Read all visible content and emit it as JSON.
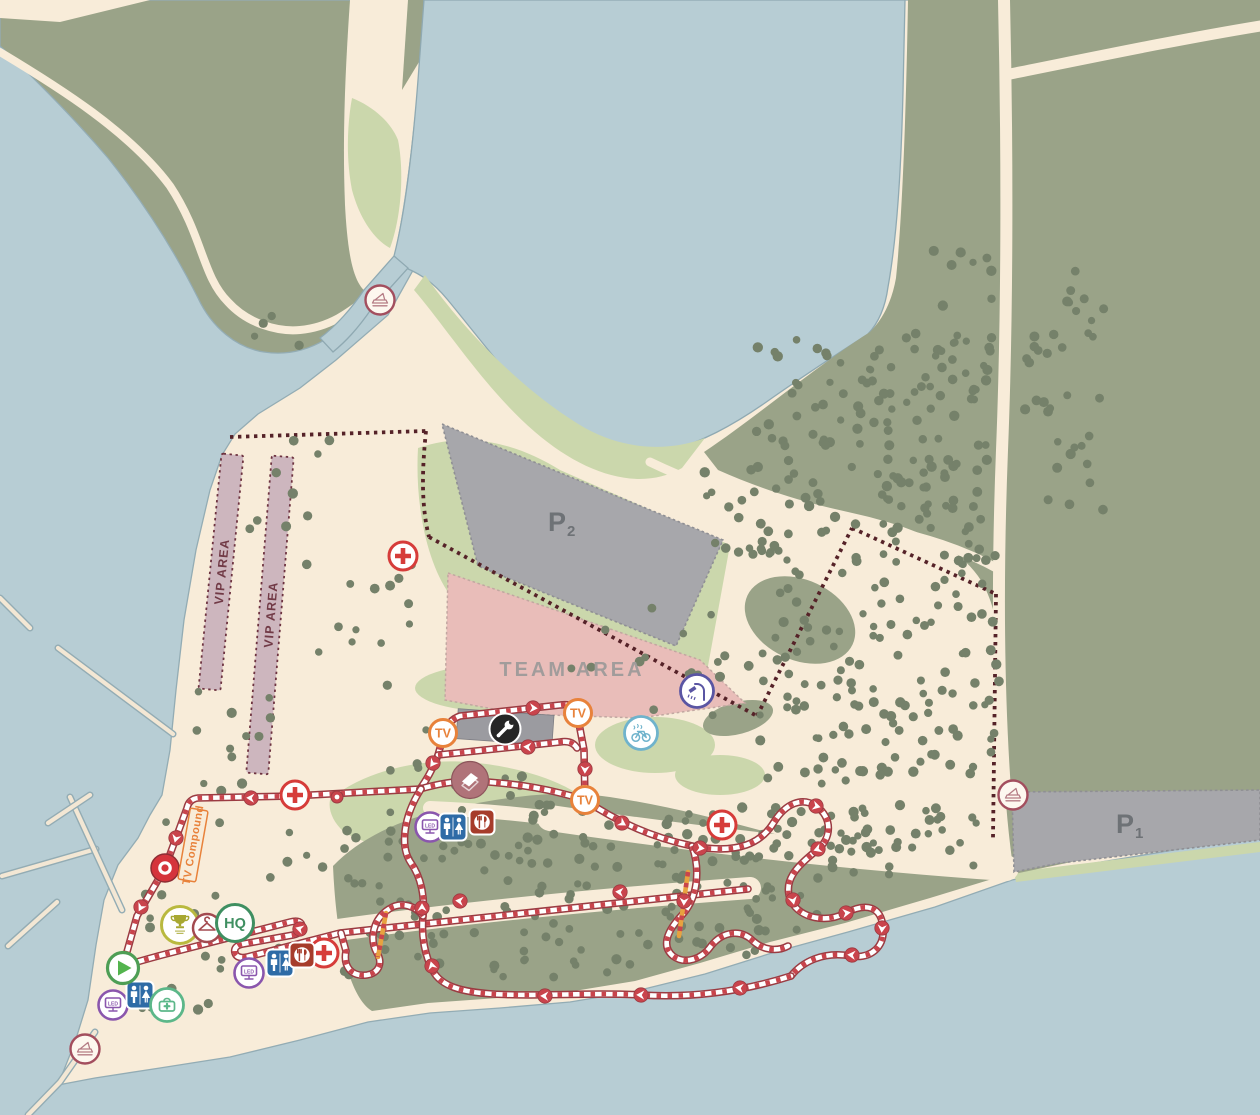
{
  "map": {
    "description": "event venue and race course map with parking, team and VIP zones, marked course loop and service icons",
    "colors": {
      "water": "#b7cdd4",
      "sand": "#f8ecd9",
      "olive_land": "#9aa388",
      "meadow": "#cbd7ac",
      "tree": "#75816a",
      "parking": "#a7a7ab",
      "team_area": "#e9bdb9",
      "vip_area": "#cdb6be",
      "boundary_dots": "#552228",
      "course_dark": "#9b3b42",
      "course_red": "#c9444c",
      "course_highlight_orange": "#e8a23f",
      "accent_orange": "#e8823b",
      "first_aid_red": "#d63c3a",
      "hq_green": "#3f8f61",
      "toilet_blue": "#2e6ba6",
      "food_red": "#a63c2b",
      "led_purple": "#8a56ad",
      "shower_indigo": "#5a55a3"
    }
  },
  "labels": {
    "p_main": "P",
    "p1_sub": "1",
    "p2_sub": "2",
    "team_area": "TEAM AREA",
    "vip_area": "VIP AREA",
    "tv_compound": "TV Compound",
    "hq": "HQ",
    "tv": "TV",
    "led": "LED"
  },
  "markers": [
    {
      "type": "ferry",
      "name": "ferry-crossing-icon",
      "x": 380,
      "y": 300
    },
    {
      "type": "ferry",
      "name": "ferry-dock-icon",
      "x": 85,
      "y": 1049
    },
    {
      "type": "ferry",
      "name": "ferry-road-icon",
      "x": 1013,
      "y": 795
    },
    {
      "type": "cross",
      "name": "first-aid-icon",
      "x": 403,
      "y": 556
    },
    {
      "type": "cross",
      "name": "first-aid-icon",
      "x": 295,
      "y": 795
    },
    {
      "type": "cross",
      "name": "first-aid-icon",
      "x": 722,
      "y": 825
    },
    {
      "type": "cross",
      "name": "first-aid-icon",
      "x": 324,
      "y": 953
    },
    {
      "type": "tv",
      "name": "tv-camera-icon",
      "x": 443,
      "y": 733
    },
    {
      "type": "tv",
      "name": "tv-camera-icon",
      "x": 578,
      "y": 713
    },
    {
      "type": "tv",
      "name": "tv-camera-icon",
      "x": 585,
      "y": 800
    },
    {
      "type": "reddot",
      "name": "course-point-marker",
      "x": 165,
      "y": 868
    },
    {
      "type": "pit",
      "name": "pit-wrench-icon",
      "x": 505,
      "y": 729
    },
    {
      "type": "flyover",
      "name": "flyover-bridge-icon",
      "x": 470,
      "y": 780
    },
    {
      "type": "shower",
      "name": "shower-icon",
      "x": 697,
      "y": 691
    },
    {
      "type": "bikewash",
      "name": "bike-wash-icon",
      "x": 641,
      "y": 733
    },
    {
      "type": "led",
      "name": "led-screen-icon",
      "x": 430,
      "y": 827
    },
    {
      "type": "led",
      "name": "led-screen-icon",
      "x": 249,
      "y": 973
    },
    {
      "type": "led",
      "name": "led-screen-icon",
      "x": 113,
      "y": 1005
    },
    {
      "type": "wc",
      "name": "toilets-icon",
      "x": 453,
      "y": 827
    },
    {
      "type": "wc",
      "name": "toilets-icon",
      "x": 280,
      "y": 963
    },
    {
      "type": "wc",
      "name": "toilets-icon",
      "x": 140,
      "y": 995
    },
    {
      "type": "food",
      "name": "catering-icon",
      "x": 482,
      "y": 822
    },
    {
      "type": "food",
      "name": "catering-icon",
      "x": 302,
      "y": 955
    },
    {
      "type": "kit",
      "name": "first-aid-post-icon",
      "x": 167,
      "y": 1005
    },
    {
      "type": "start",
      "name": "start-finish-icon",
      "x": 123,
      "y": 968
    },
    {
      "type": "trophy",
      "name": "podium-icon",
      "x": 180,
      "y": 925
    },
    {
      "type": "hanger",
      "name": "changing-rooms-icon",
      "x": 207,
      "y": 928
    },
    {
      "type": "hq",
      "name": "hq-icon",
      "x": 235,
      "y": 923
    },
    {
      "type": "node",
      "name": "course-node-marker",
      "x": 337,
      "y": 797
    }
  ],
  "course_arrows": [
    [
      141,
      907,
      118
    ],
    [
      176,
      838,
      105
    ],
    [
      251,
      798,
      183
    ],
    [
      433,
      763,
      125
    ],
    [
      533,
      708,
      4
    ],
    [
      528,
      747,
      184
    ],
    [
      585,
      769,
      92
    ],
    [
      622,
      823,
      32
    ],
    [
      700,
      848,
      8
    ],
    [
      816,
      806,
      15
    ],
    [
      818,
      849,
      160
    ],
    [
      793,
      900,
      78
    ],
    [
      846,
      913,
      352
    ],
    [
      882,
      928,
      95
    ],
    [
      852,
      955,
      185
    ],
    [
      740,
      988,
      187
    ],
    [
      641,
      995,
      181
    ],
    [
      545,
      996,
      182
    ],
    [
      432,
      966,
      255
    ],
    [
      422,
      908,
      270
    ],
    [
      684,
      901,
      93
    ],
    [
      300,
      929,
      196
    ],
    [
      460,
      901,
      186
    ],
    [
      620,
      892,
      185
    ]
  ],
  "tree_regions": [
    [
      755,
      335,
      240,
      200,
      130
    ],
    [
      760,
      540,
      242,
      245,
      140
    ],
    [
      700,
      455,
      90,
      105,
      20
    ],
    [
      1020,
      270,
      90,
      240,
      36
    ],
    [
      908,
      240,
      85,
      215,
      20
    ],
    [
      340,
      810,
      320,
      170,
      100
    ],
    [
      660,
      805,
      320,
      70,
      80
    ],
    [
      660,
      875,
      160,
      60,
      25
    ],
    [
      660,
      925,
      100,
      30,
      10
    ],
    [
      240,
      440,
      100,
      90,
      9
    ],
    [
      300,
      555,
      120,
      150,
      14
    ],
    [
      195,
      690,
      150,
      110,
      12
    ],
    [
      140,
      810,
      200,
      200,
      26
    ],
    [
      380,
      755,
      180,
      100,
      14
    ],
    [
      560,
      600,
      160,
      110,
      12
    ],
    [
      690,
      640,
      110,
      80,
      8
    ],
    [
      420,
      700,
      80,
      50,
      5
    ],
    [
      240,
      305,
      70,
      45,
      4
    ]
  ]
}
